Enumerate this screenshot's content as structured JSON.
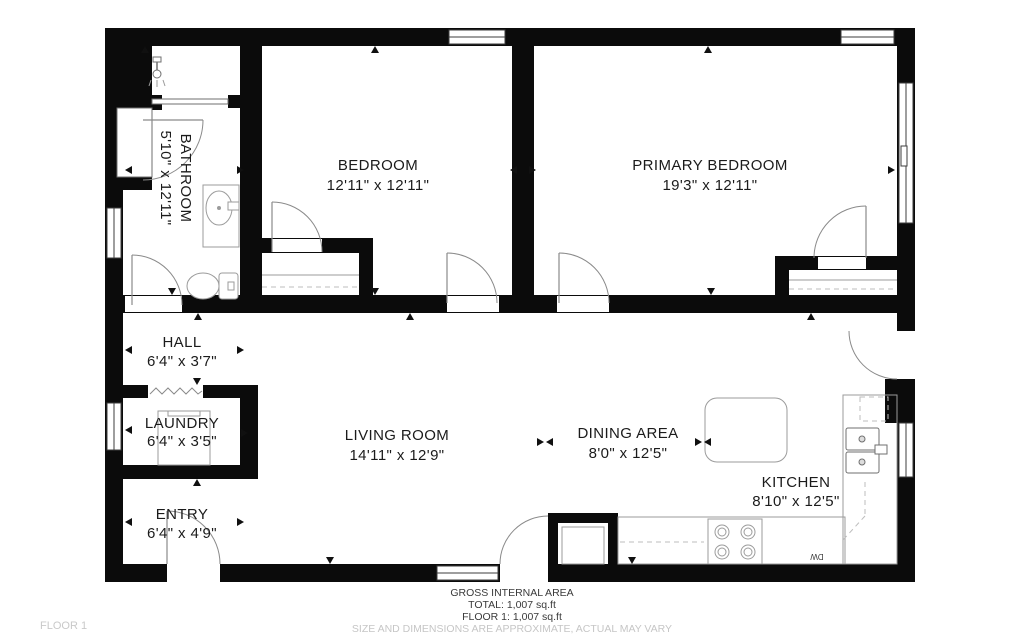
{
  "floor_label": "FLOOR 1",
  "footer": {
    "line1": "GROSS INTERNAL AREA",
    "line2": "TOTAL: 1,007 sq.ft",
    "line3": "FLOOR 1: 1,007 sq.ft",
    "disclaimer": "SIZE AND DIMENSIONS ARE APPROXIMATE, ACTUAL MAY VARY"
  },
  "rooms": {
    "bathroom": {
      "name": "BATHROOM",
      "dims": "5'10\" x 12'11\""
    },
    "bedroom": {
      "name": "BEDROOM",
      "dims": "12'11\" x 12'11\""
    },
    "primary_bedroom": {
      "name": "PRIMARY BEDROOM",
      "dims": "19'3\" x 12'11\""
    },
    "hall": {
      "name": "HALL",
      "dims": "6'4\" x 3'7\""
    },
    "laundry": {
      "name": "LAUNDRY",
      "dims": "6'4\" x 3'5\""
    },
    "living_room": {
      "name": "LIVING ROOM",
      "dims": "14'11\" x 12'9\""
    },
    "dining_area": {
      "name": "DINING AREA",
      "dims": "8'0\" x 12'5\""
    },
    "kitchen": {
      "name": "KITCHEN",
      "dims": "8'10\" x 12'5\""
    },
    "entry": {
      "name": "ENTRY",
      "dims": "6'4\" x 4'9\""
    }
  },
  "appliances": {
    "dishwasher_label": "DW"
  },
  "colors": {
    "wall": "#0b0b0b",
    "fixture_stroke": "#9b9b9b",
    "text": "#1b1b1b",
    "muted": "#c6c6c6"
  }
}
